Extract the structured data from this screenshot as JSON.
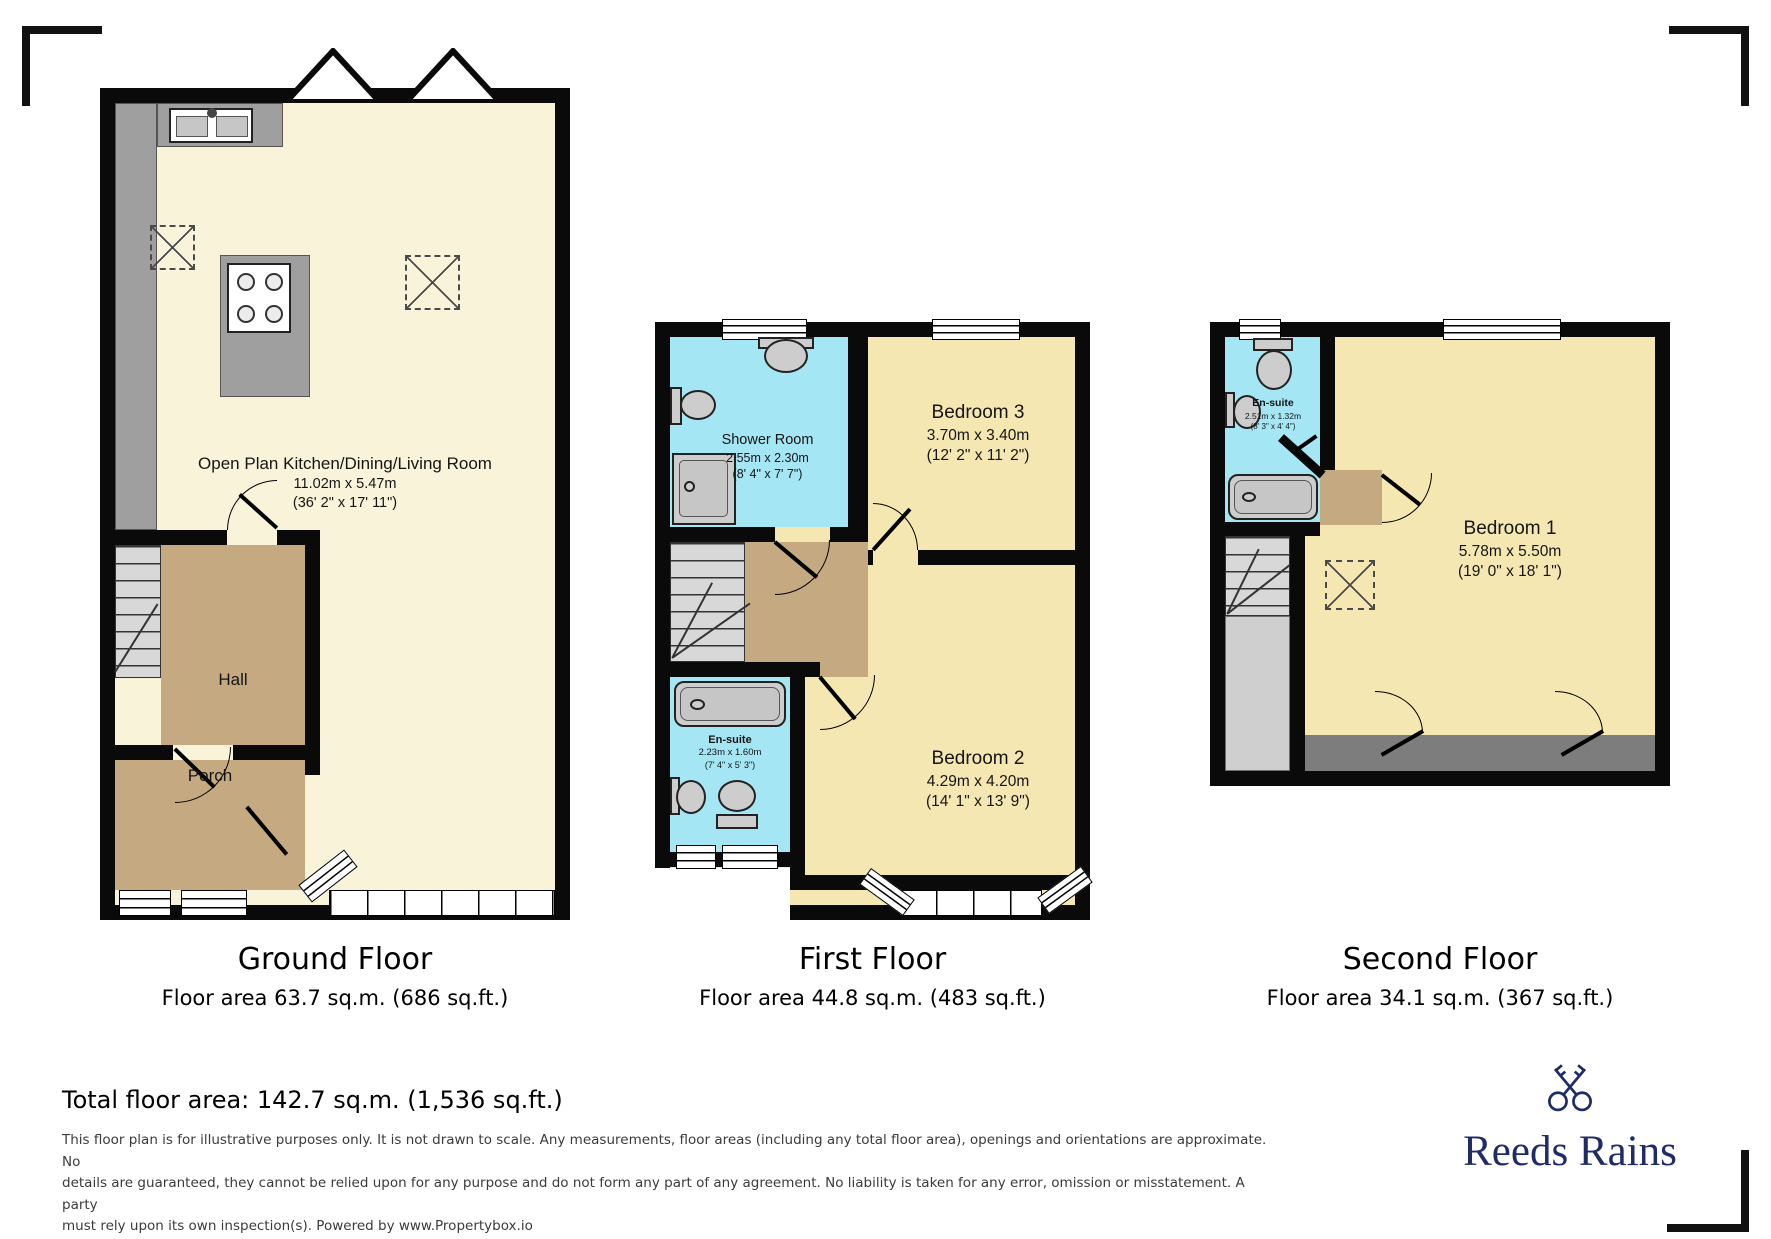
{
  "ground_floor": {
    "title": "Ground Floor",
    "area_label": "Floor area 63.7 sq.m. (686 sq.ft.)",
    "rooms": {
      "living": {
        "name": "Open Plan Kitchen/Dining/Living Room",
        "metric": "11.02m x 5.47m",
        "imperial": "(36' 2\" x 17' 11\")"
      },
      "hall": {
        "name": "Hall"
      },
      "porch": {
        "name": "Porch"
      }
    }
  },
  "first_floor": {
    "title": "First Floor",
    "area_label": "Floor area 44.8 sq.m. (483 sq.ft.)",
    "rooms": {
      "shower_room": {
        "name": "Shower Room",
        "metric": "2.55m x 2.30m",
        "imperial": "(8' 4\" x 7' 7\")"
      },
      "bedroom3": {
        "name": "Bedroom 3",
        "metric": "3.70m x 3.40m",
        "imperial": "(12' 2\" x 11' 2\")"
      },
      "ensuite": {
        "name": "En-suite",
        "metric": "2.23m x 1.60m",
        "imperial": "(7' 4\" x 5' 3\")"
      },
      "bedroom2": {
        "name": "Bedroom 2",
        "metric": "4.29m x 4.20m",
        "imperial": "(14' 1\" x 13' 9\")"
      }
    }
  },
  "second_floor": {
    "title": "Second Floor",
    "area_label": "Floor area 34.1 sq.m. (367 sq.ft.)",
    "rooms": {
      "ensuite": {
        "name": "En-suite",
        "metric": "2.51m x 1.32m",
        "imperial": "(8' 3\" x 4' 4\")"
      },
      "bedroom1": {
        "name": "Bedroom 1",
        "metric": "5.78m x 5.50m",
        "imperial": "(19' 0\" x 18' 1\")"
      }
    }
  },
  "footer": {
    "total": "Total floor area: 142.7 sq.m. (1,536 sq.ft.)",
    "disclaimer_lines": [
      "This floor plan is for illustrative purposes only. It is not drawn to scale. Any measurements, floor areas (including any total floor area), openings and orientations are approximate. No",
      "details are guaranteed, they cannot be relied upon for any purpose and do not form any part of any agreement. No liability is taken for any error, omission or misstatement. A party",
      "must rely upon its own inspection(s). Powered by www.Propertybox.io"
    ]
  },
  "brand": {
    "name": "Reeds Rains"
  },
  "palette": {
    "bedroom_fill": "#f5e7b2",
    "living_fill": "#f9f3da",
    "bathroom_fill": "#a5e6f5",
    "hall_fill": "#c5a980",
    "wall": "#0a0a0a",
    "brand_navy": "#1e2c68"
  }
}
